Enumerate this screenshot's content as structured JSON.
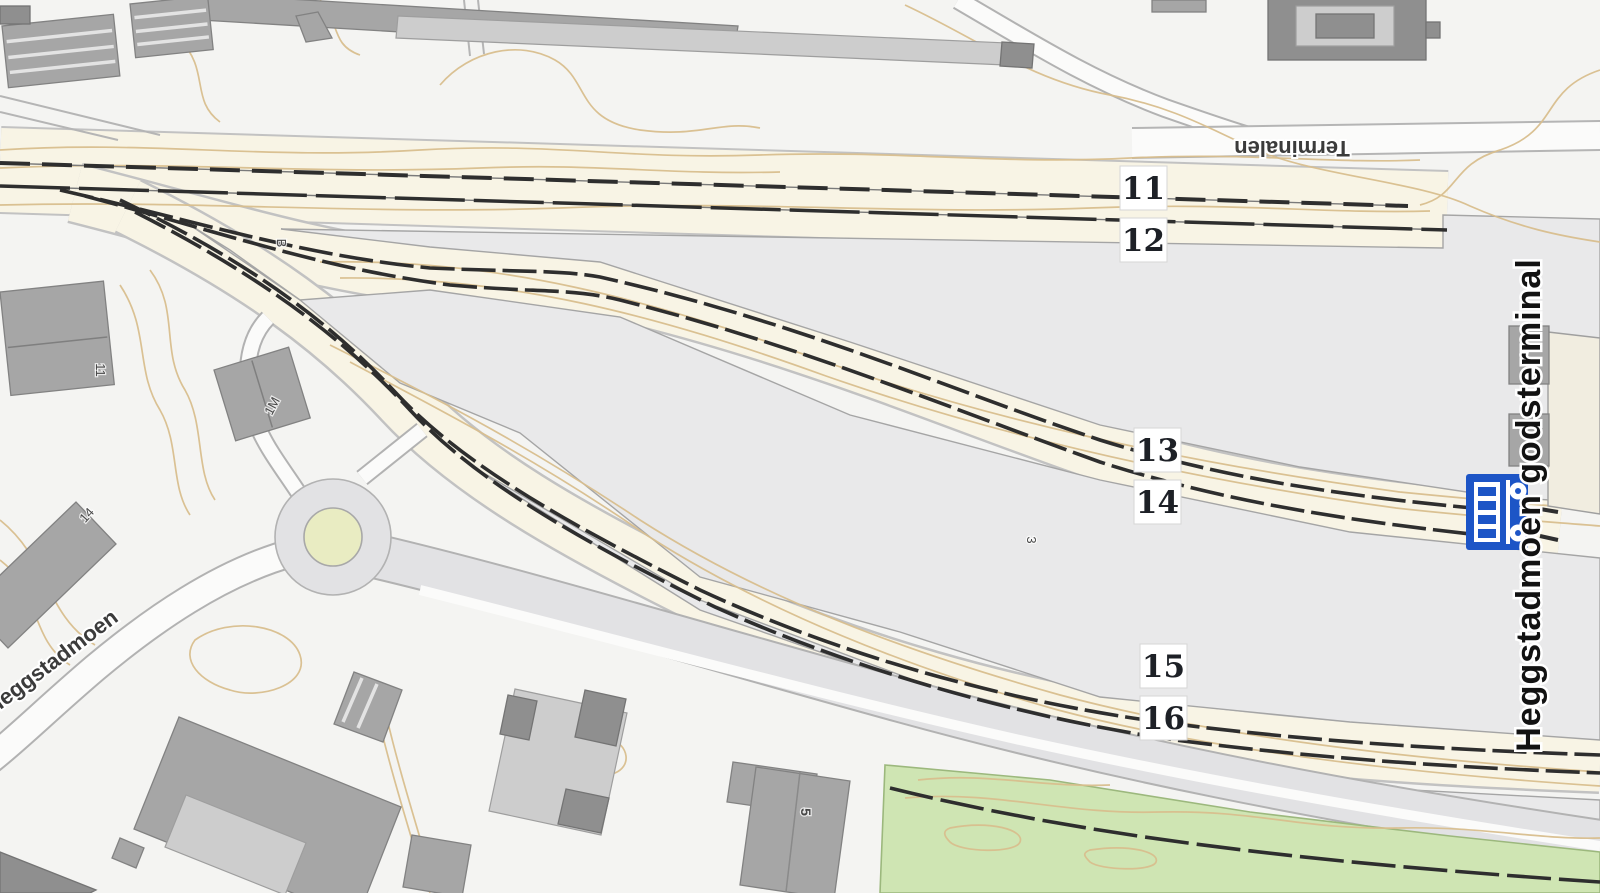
{
  "map": {
    "terminal_label": "Heggstadmoen godsterminal",
    "streets": {
      "terminalen": "Terminalen",
      "heggstadmoen": "Heggstadmoen"
    },
    "tracks": [
      "11",
      "12",
      "13",
      "14",
      "15",
      "16"
    ],
    "site_labels": {
      "b": "B",
      "three": "3",
      "five": "5",
      "eleven": "11",
      "one_m": "1M",
      "fourteen": "14"
    },
    "icons": {
      "freight_terminal": "freight-terminal-icon"
    },
    "colors": {
      "background": "#f4f4f2",
      "rail_corridor": "#f8f4e5",
      "corridor_edge": "#c2c2c2",
      "terminal_area": "#e9e9ea",
      "terminal_edge": "#a5a5a5",
      "contour": "#d8be8d",
      "track": "#2e2e2e",
      "building": "#a6a6a6",
      "building_dark": "#8f8f8f",
      "building_light": "#cdcdcd",
      "road_fill": "#e2e2e4",
      "road_edge": "#b2b2b2",
      "green_area": "#cfe5b3",
      "green_edge": "#9cb87d",
      "chip_bg": "#ffffff",
      "chip_border": "#d6d6d6",
      "label_dark": "#1d2026",
      "map_label": "#3b3b3b",
      "icon_blue": "#1d55c6",
      "roundabout_center": "#e9ecc2"
    }
  }
}
